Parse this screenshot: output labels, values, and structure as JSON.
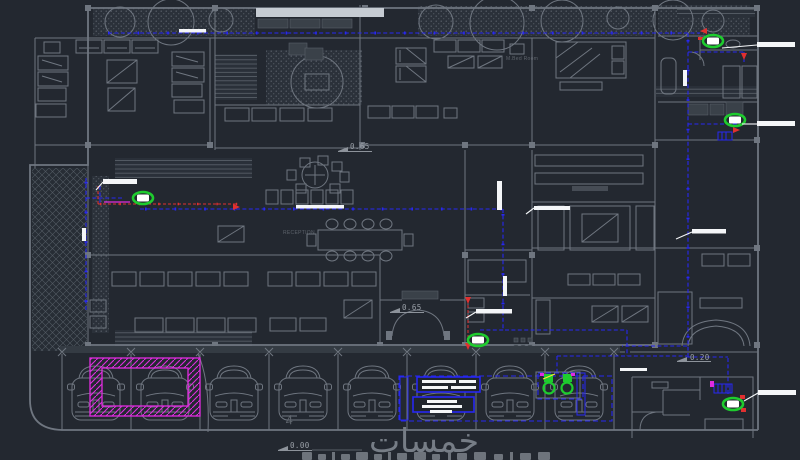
{
  "drawing": {
    "type": "cad-floor-plan",
    "watermark": "خمسات",
    "labels": {
      "level_center": "0.65",
      "level_entrance": "0.65",
      "level_parking": "0.00",
      "level_side": "0.20",
      "room_reception": "RECEPTION",
      "room_master_bed": "M.Bed Room",
      "stall_number": "4"
    },
    "colors": {
      "bg": "#232830",
      "wall": "#6f7680",
      "wall-light": "#9aa1aa",
      "blue": "#2727f2",
      "red": "#e03030",
      "magenta": "#e02ce0",
      "green": "#1ecc2e",
      "white": "#f4f6f8",
      "watermark": "#767d86"
    }
  }
}
